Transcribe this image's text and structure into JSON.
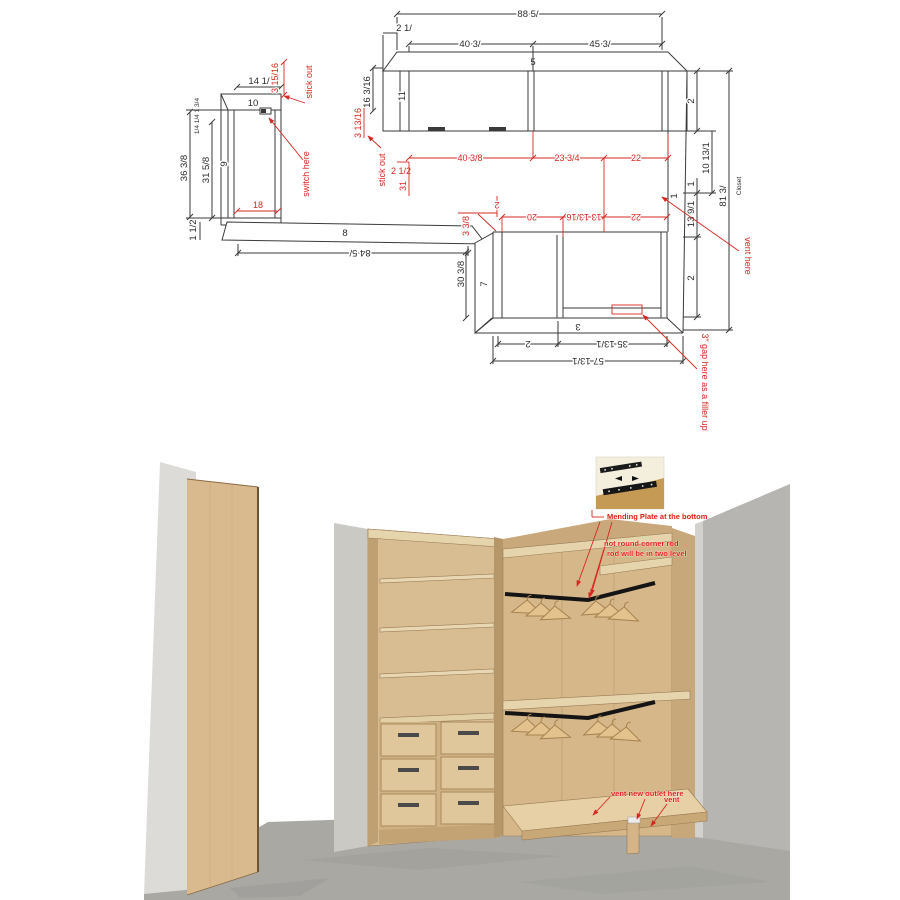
{
  "title": "Closet design - plan and rendering",
  "colors": {
    "line": "#3a3a3a",
    "red": "#d62720",
    "wood": "#d8bd92",
    "wood_light": "#e6d4ad",
    "wood_dark": "#b6976a",
    "wall_gray": "#b6b5b1",
    "floor_gray": "#a9a8a3",
    "rod_black": "#141414"
  },
  "plan": {
    "black_dims": {
      "overall_width": "88 5/",
      "left_offset": "2 1/",
      "bay_left_width": "40 3/",
      "bay_right_width": "45 3/",
      "top_depth": "5",
      "left_end_panel": "11",
      "left_return": "16 3/16",
      "left_cab_width": "14 1/",
      "left_cab_top": "10",
      "left_cab_side": "9",
      "left_edge_stack": "1/4 1/4 1 3/4",
      "left_height_outer": "36 3/8",
      "left_height_inner": "31 5/8",
      "left_base": "1 1/2",
      "bottom_wall": "8",
      "bottom_wall_length": "84 5/",
      "lower_depth": "30 3/8",
      "lower_side": "7",
      "lower_bottom": "3",
      "bottom_seg_small": "2",
      "bottom_seg_right": "35 13/1",
      "bottom_total": "57 13/1",
      "right_seg_top": "2",
      "right_upper": "10 13/1",
      "right_one": "1",
      "right_wall": "1",
      "right_mid": "13 9/1",
      "right_seg_bottom": "2",
      "right_total": "81 3/",
      "closet_label": "Closet"
    },
    "red_dims": {
      "left_cab_gap": "3 15/16",
      "stick_out_left": "stick out",
      "switch_note": "switch here",
      "left_cab_inner": "18",
      "upper_gap": "3 13/16",
      "stick_out_mid": "stick out",
      "upper_offset": "2 1/2",
      "upper_return": "31",
      "upper_seg1": "40 3/8",
      "upper_seg2": "23 3/4",
      "upper_seg3": "22",
      "lower_offset": "2",
      "lower_seg1": "20",
      "lower_seg2": "13 13/16",
      "lower_seg3": "22",
      "step_height": "3 3/8",
      "gap_note": "3\" gap here as a filler up",
      "vent_note": "vent here"
    }
  },
  "render": {
    "annotations": {
      "mending_plate": "Mending Plate at the bottom",
      "rod_note_1": "not round corner rod",
      "rod_note_2": "rod will be in two level",
      "vent_outlet": "vent new outlet here",
      "vent": "vent"
    }
  }
}
